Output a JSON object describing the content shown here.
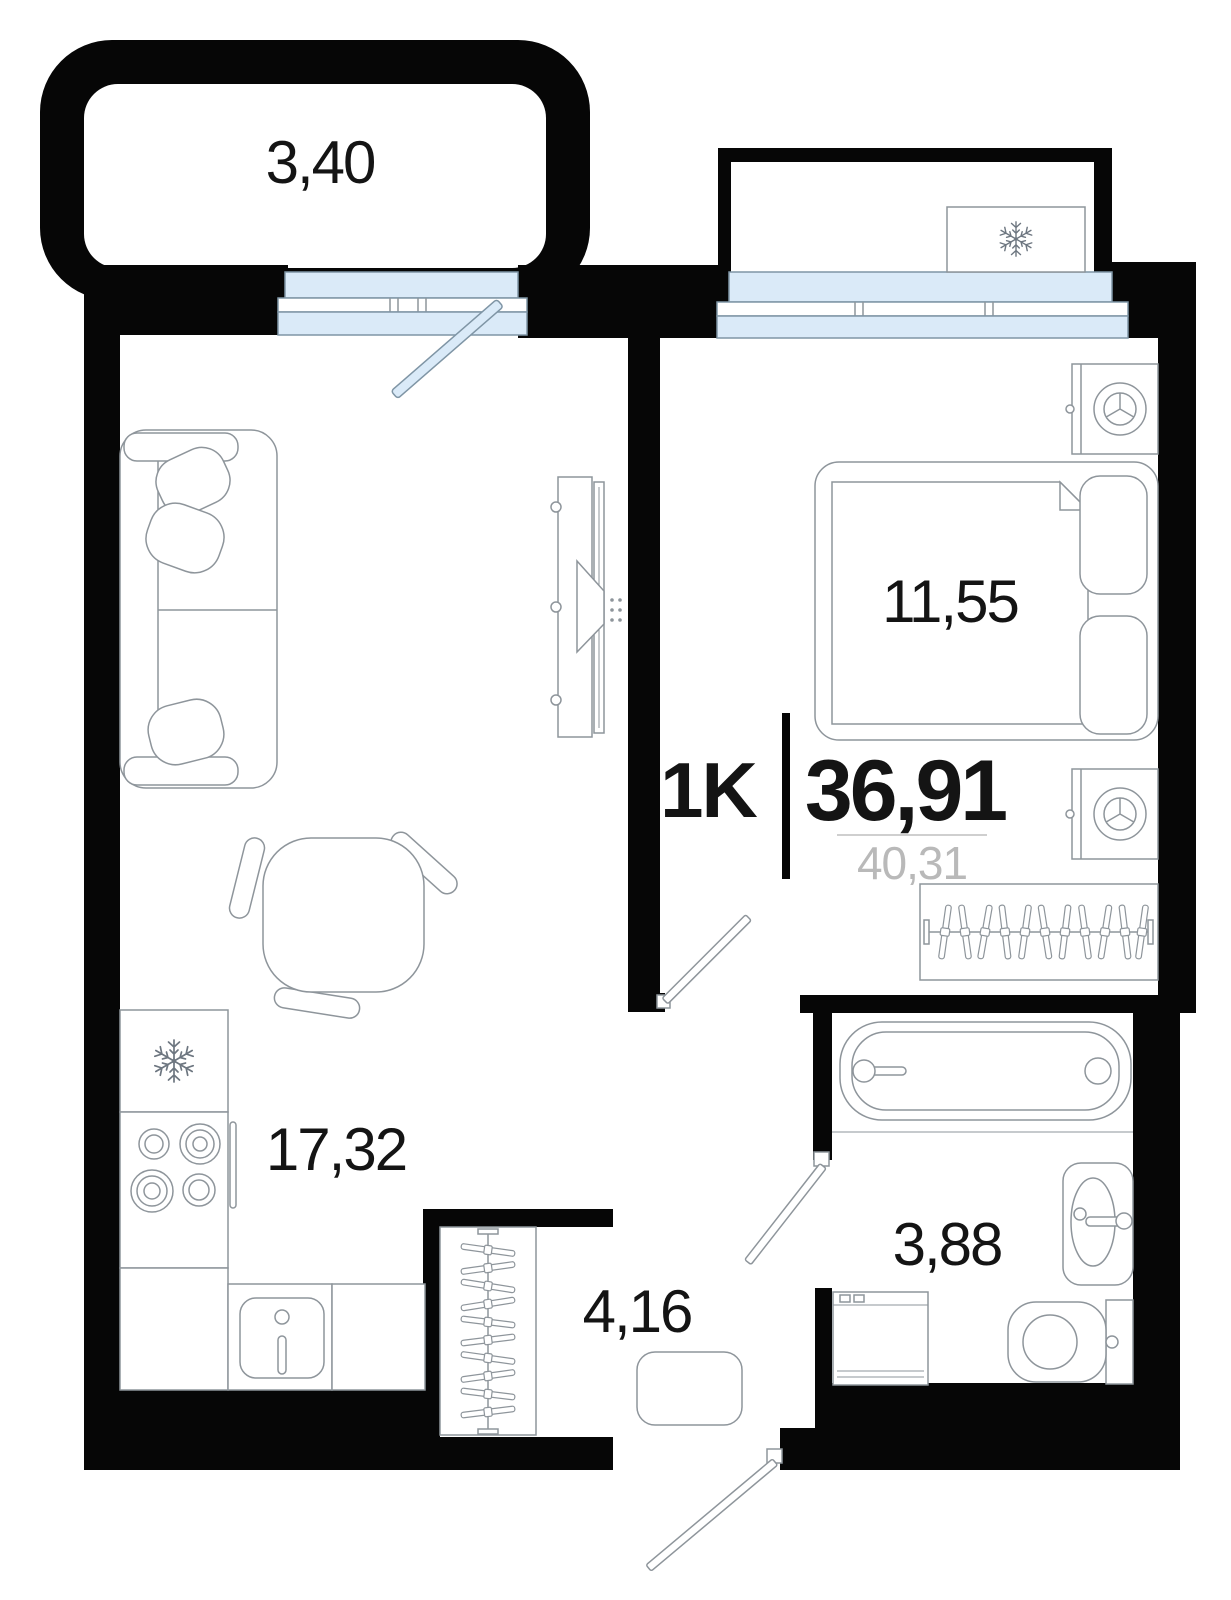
{
  "floor_plan": {
    "title": "1-room apartment floor plan",
    "type_label": "1K",
    "total_area": "36,91",
    "secondary_area": "40,31",
    "rooms": {
      "balcony": "3,40",
      "bedroom": "11,55",
      "living_kitchen": "17,32",
      "hallway": "4,16",
      "bathroom": "3,88"
    },
    "icons": [
      "snowflake-icon",
      "hanger-icon",
      "burner-icon"
    ],
    "colors": {
      "wall": "#060606",
      "glazing_fill": "#daeaf8",
      "glazing_stroke": "#7f95a5",
      "furniture_stroke": "#8e959b",
      "muted_text": "#b9b9b9"
    }
  }
}
